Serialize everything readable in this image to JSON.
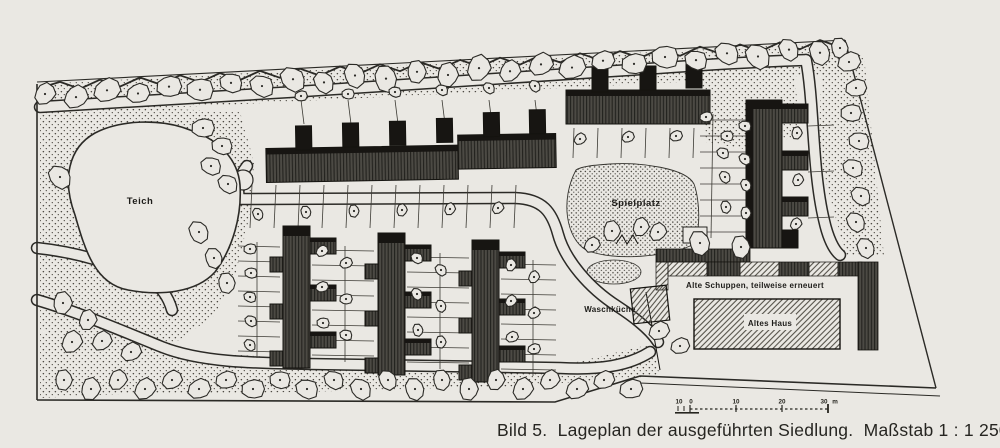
{
  "figure": {
    "caption": "Bild 5.  Lageplan der ausgeführten Siedlung.  Maßstab 1 : 1 250."
  },
  "map": {
    "labels": {
      "pond": "Teich",
      "playground": "Spielplatz",
      "laundry": "Waschküche",
      "sheds": "Alte Schuppen, teilweise erneuert",
      "old_house": "Altes Haus"
    },
    "scale_bar": {
      "ticks": [
        "10",
        "0",
        "10",
        "20",
        "30"
      ],
      "unit": "m"
    },
    "colors": {
      "paper": "#eae8e3",
      "ink": "#2b2a26",
      "building_dark": "#4c4a44",
      "building_shadow": "#171512"
    }
  }
}
